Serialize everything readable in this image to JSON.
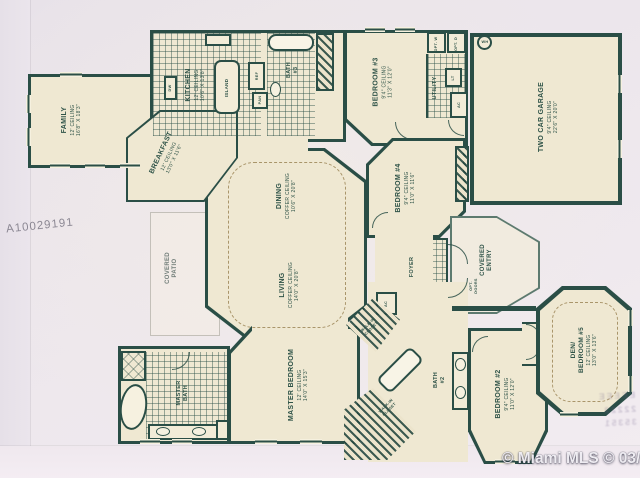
{
  "watermarks": {
    "mls_id": "A10029191",
    "credit": "© Miami MLS © 03/2016"
  },
  "bleedthrough": {
    "line1": "EEEEE",
    "line2": "22222",
    "line3": "35351"
  },
  "rooms": {
    "family": {
      "name": "FAMILY",
      "ceiling": "12' CEILING",
      "dims": "16'8\" X 18'3\""
    },
    "kitchen": {
      "name": "KITCHEN",
      "ceiling": "12' CEILING",
      "dims": "10'6\" X 13'8\""
    },
    "breakfast": {
      "name": "BREAKFAST",
      "ceiling": "12' CEILING",
      "dims": "13'0\" X 11'6\""
    },
    "bath3": {
      "name": "BATH #3"
    },
    "bedroom3": {
      "name": "BEDROOM #3",
      "ceiling": "9'4\" CEILING",
      "dims": "11'3\" X 12'0\""
    },
    "utility": {
      "name": "UTILITY"
    },
    "garage": {
      "name": "TWO CAR GARAGE",
      "ceiling": "9'4\" CEILING",
      "dims": "22'6\" X 20'0\""
    },
    "bedroom4": {
      "name": "BEDROOM #4",
      "ceiling": "9'4\" CEILING",
      "dims": "11'0\" X 11'6\""
    },
    "dining": {
      "name": "DINING",
      "ceiling": "COFFER CEILING",
      "dims": "10'6\" X 20'8\""
    },
    "living": {
      "name": "LIVING",
      "ceiling": "COFFER CEILING",
      "dims": "14'0\" X 20'8\""
    },
    "covered_patio": {
      "name": "COVERED PATIO"
    },
    "foyer": {
      "name": "FOYER"
    },
    "covered_entry": {
      "name": "COVERED ENTRY"
    },
    "master_bedroom": {
      "name": "MASTER BEDROOM",
      "ceiling": "12' CEILING",
      "dims": "14'0\" X 15'3\""
    },
    "master_bath": {
      "name": "MASTER BATH"
    },
    "walkin_closet": {
      "name": "WALK-IN CLOSET"
    },
    "bath2": {
      "name": "BATH #2"
    },
    "bedroom2": {
      "name": "BEDROOM #2",
      "ceiling": "9'4\" CEILING",
      "dims": "11'0\" X 12'0\""
    },
    "den": {
      "name": "DEN/ BEDROOM #5",
      "ceiling": "12' CEILING",
      "dims": "13'0\" X 13'6\""
    }
  },
  "fixtures": {
    "island": "ISLAND",
    "dw": "DW",
    "ref": "REF",
    "pan": "PAN",
    "opt_w": "OPT. W",
    "opt_d": "OPT. D",
    "lt": "LT",
    "wh": "WH",
    "ac": "AC",
    "opt_doors": "OPT. DOORS"
  },
  "colors": {
    "wall": "#2a4e46",
    "paper": "#efe8d2",
    "photo_bg": "#ece6ec"
  }
}
